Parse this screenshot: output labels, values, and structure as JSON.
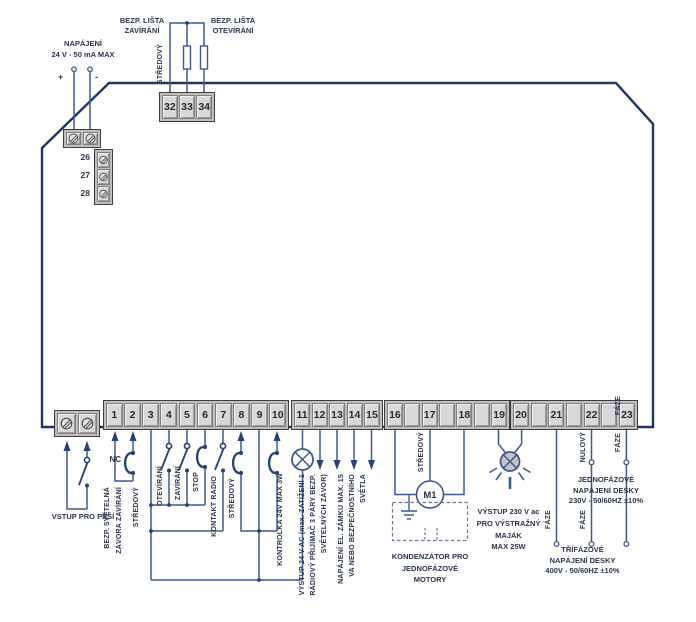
{
  "colors": {
    "wire": "#3c5a90",
    "outline": "#1d3866",
    "symbol": "#24427a",
    "strip_bg": "#bfbfbf",
    "cell_bg": "#d8d8d8",
    "text": "#2c3550"
  },
  "top_left": {
    "title": "NAPÁJENÍ",
    "subtitle": "24 V - 50 mA MAX",
    "plus": "+",
    "minus": "-",
    "side_terminals": [
      "26",
      "27",
      "28"
    ]
  },
  "top_center": {
    "left_line1": "BEZP. LIŠTA",
    "left_line2": "ZAVÍRÁNÍ",
    "right_line1": "BEZP. LIŠTA",
    "right_line2": "OTEVÍRÁNÍ",
    "common": "STŘEDOVÝ",
    "terminals": [
      "32",
      "33",
      "34"
    ]
  },
  "strips": {
    "a": [
      "1",
      "2",
      "3",
      "4",
      "5",
      "6",
      "7",
      "8",
      "9",
      "10"
    ],
    "b": [
      "11",
      "12",
      "13",
      "14",
      "15"
    ],
    "c": [
      "16",
      "",
      "17",
      "",
      "18",
      "",
      "19"
    ],
    "d": [
      "20",
      "",
      "21",
      "",
      "22",
      "",
      "23"
    ]
  },
  "labels": {
    "vstup_pesi": "VSTUP PRO PĚŠÍ",
    "nc": "NC",
    "bezp_svetelna": "BEZP. SVĚTELNÁ",
    "zavora_zavirani": "ZÁVORA ZAVÍRÁNÍ",
    "stredovy_t2": "STŘEDOVÝ",
    "otevirani": "OTEVÍRÁNÍ",
    "zavirani": "ZAVÍRÁNÍ",
    "stop": "STOP",
    "kontakt_radio": "KONTAKT RADIO",
    "stredovy_t8": "STŘEDOVÝ",
    "kontrolka": "KONTROLKA 24V MAX 3W",
    "vystup24_1": "VÝSTUP 24 V AC (max. ZATÍŽENÍ 1",
    "vystup24_2": "RÁDIOVÝ PŘIJÍMAČ 3 PÁRY BEZP.",
    "vystup24_3": "SVĚTELNÝCH ZÁVOR)",
    "zamek_1": "NAPÁJENÍ EL. ZÁMKU MAX. 15",
    "zamek_2": "VA NEBO BEZPEČNOSTNÍHO",
    "zamek_3": "SVĚTLA",
    "stredovy_t17": "STŘEDOVÝ",
    "motor": "M1",
    "kondenzator_1": "KONDENZÁTOR PRO",
    "kondenzator_2": "JEDNOFÁZOVÉ",
    "kondenzator_3": "MOTORY",
    "majak_1": "VÝSTUP 230 V ac",
    "majak_2": "PRO VÝSTRAŽNÝ",
    "majak_3": "MAJÁK",
    "majak_4": "MAX 25W",
    "faze_t21": "FÁZE",
    "nulovy_t22": "NULOVÝ",
    "faze_t22": "FÁZE",
    "faze_t23_top": "FÁZE",
    "faze_t23": "FÁZE",
    "jedno_1": "JEDNOFÁZOVÉ",
    "jedno_2": "NAPÁJENÍ DESKY",
    "jedno_3": "230V - 50/60HZ ±10%",
    "tri_1": "TŘÍFÁZOVÉ",
    "tri_2": "NAPÁJENÍ DESKY",
    "tri_3": "400V - 50/60HZ ±10%"
  }
}
